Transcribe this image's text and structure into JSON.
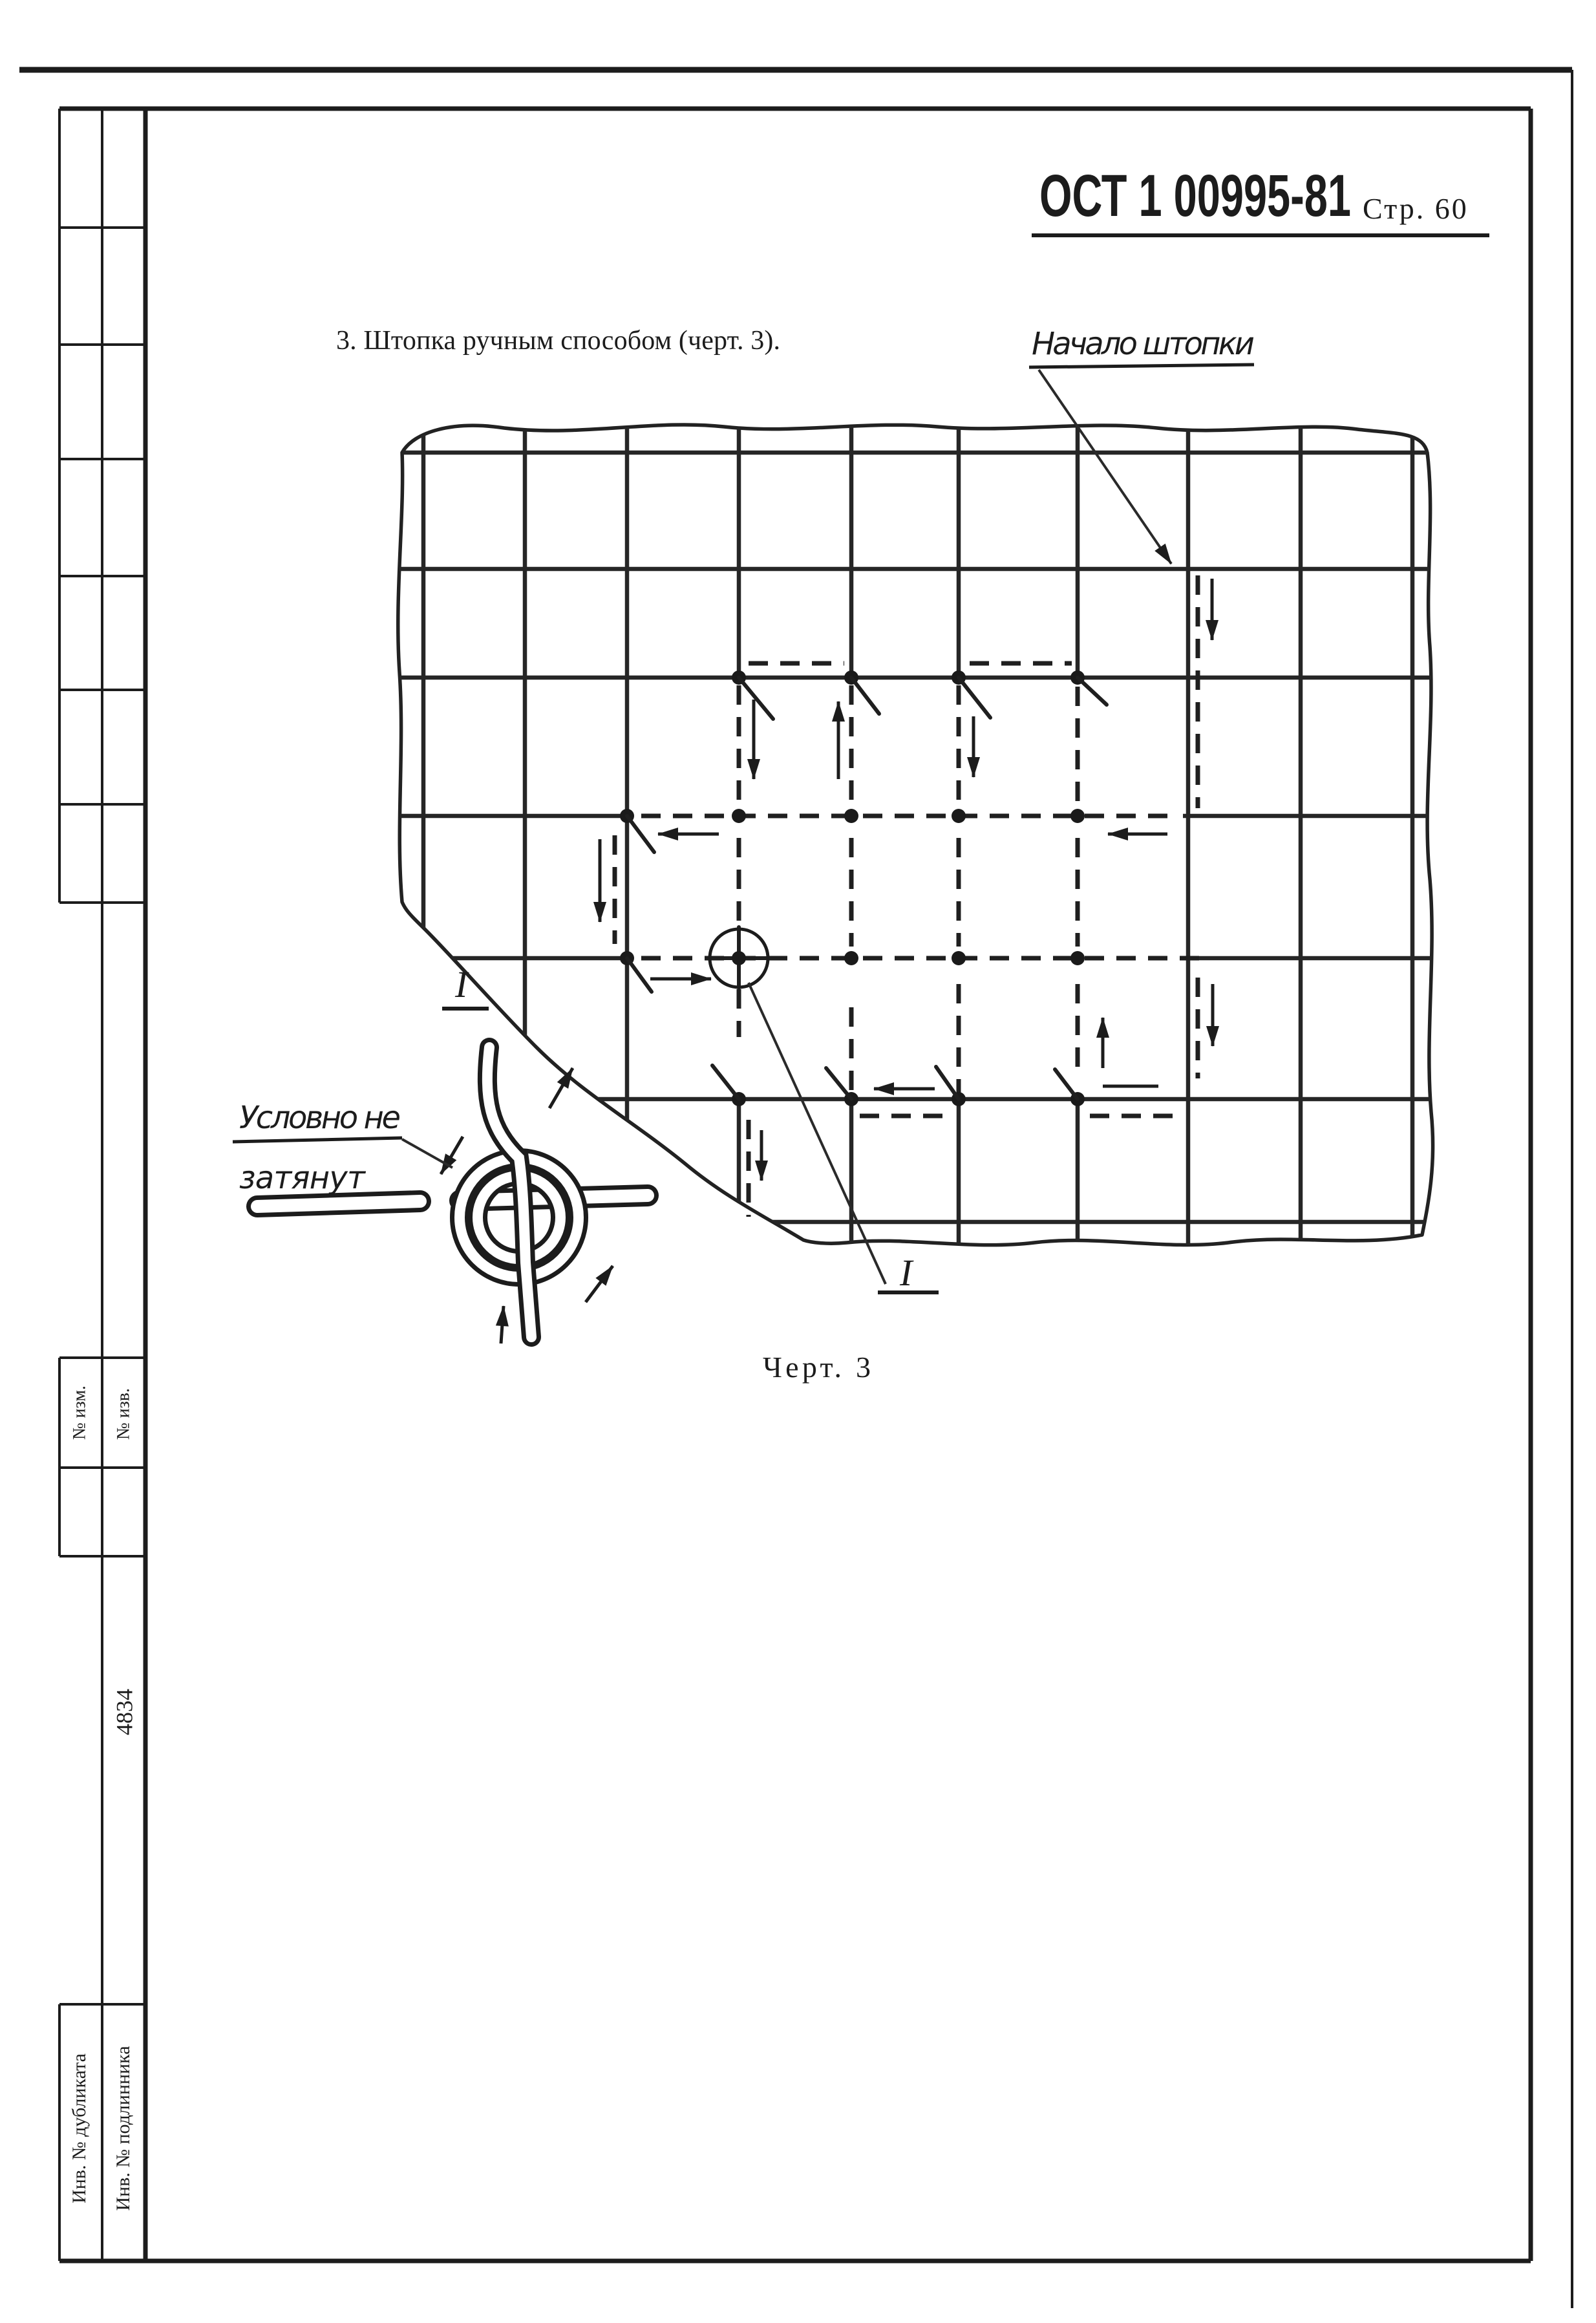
{
  "header": {
    "standard": "ОСТ 1 00995-81",
    "page": "Стр. 60"
  },
  "title": "3. Штопка ручным способом (черт. 3).",
  "figure": {
    "caption": "Черт. 3",
    "labels": {
      "start": "Начало штопки",
      "knot_line1": "Условно не",
      "knot_line2": "затянут",
      "section_left": "I",
      "section_bottom": "I"
    }
  },
  "sidebar": {
    "no_izm": "№ изм.",
    "no_izv": "№ изв.",
    "form_number": "4834",
    "inv_duplicate": "Инв. № дубликата",
    "inv_original": "Инв. № подлинника"
  },
  "colors": {
    "ink": "#1c1c1c",
    "paper": "#ffffff"
  }
}
